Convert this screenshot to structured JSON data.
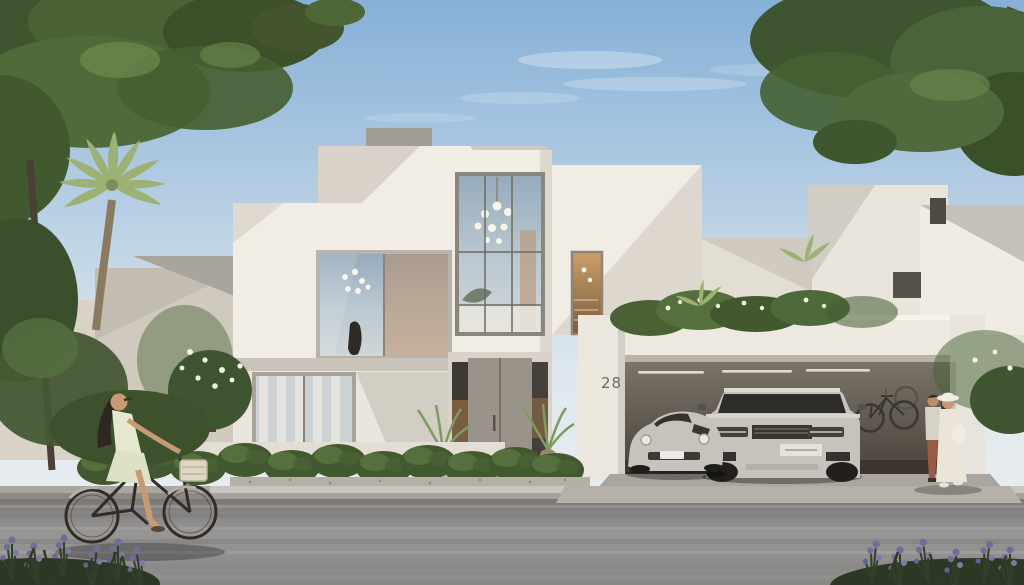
{
  "scene": {
    "title": "Modern villa exterior architectural rendering",
    "house_number": "28",
    "setting": "daytime residential street with trees and landscaping",
    "objects": [
      "geometric-white-villa",
      "double-height-glass-atrium-with-chandelier",
      "open-carport",
      "porsche-sports-car",
      "range-rover-suv",
      "wall-mounted-bicycle",
      "woman-riding-bicycle",
      "walking-couple",
      "palm-tree",
      "shade-trees",
      "hedgerow-and-planter",
      "lavender-plants",
      "neighbor-houses",
      "asphalt-road"
    ]
  },
  "palette": {
    "sky_top": "#86b0d7",
    "sky_horizon": "#dfe8ee",
    "villa_face": "#f1ece4",
    "villa_shadow": "#d8d2c8",
    "villa_dark_facet": "#bdb7ad",
    "glass": "#a4b6c3",
    "interior_warm": "#b78a5e",
    "garage_interior": "#7d7569",
    "garage_dark": "#49433b",
    "road": "#908e8c",
    "foliage_dark": "#3e5530",
    "foliage_light": "#6d8a4f",
    "palm": "#a3b77e",
    "lavender": "#716d99",
    "car_silver": "#c6c3bd"
  }
}
